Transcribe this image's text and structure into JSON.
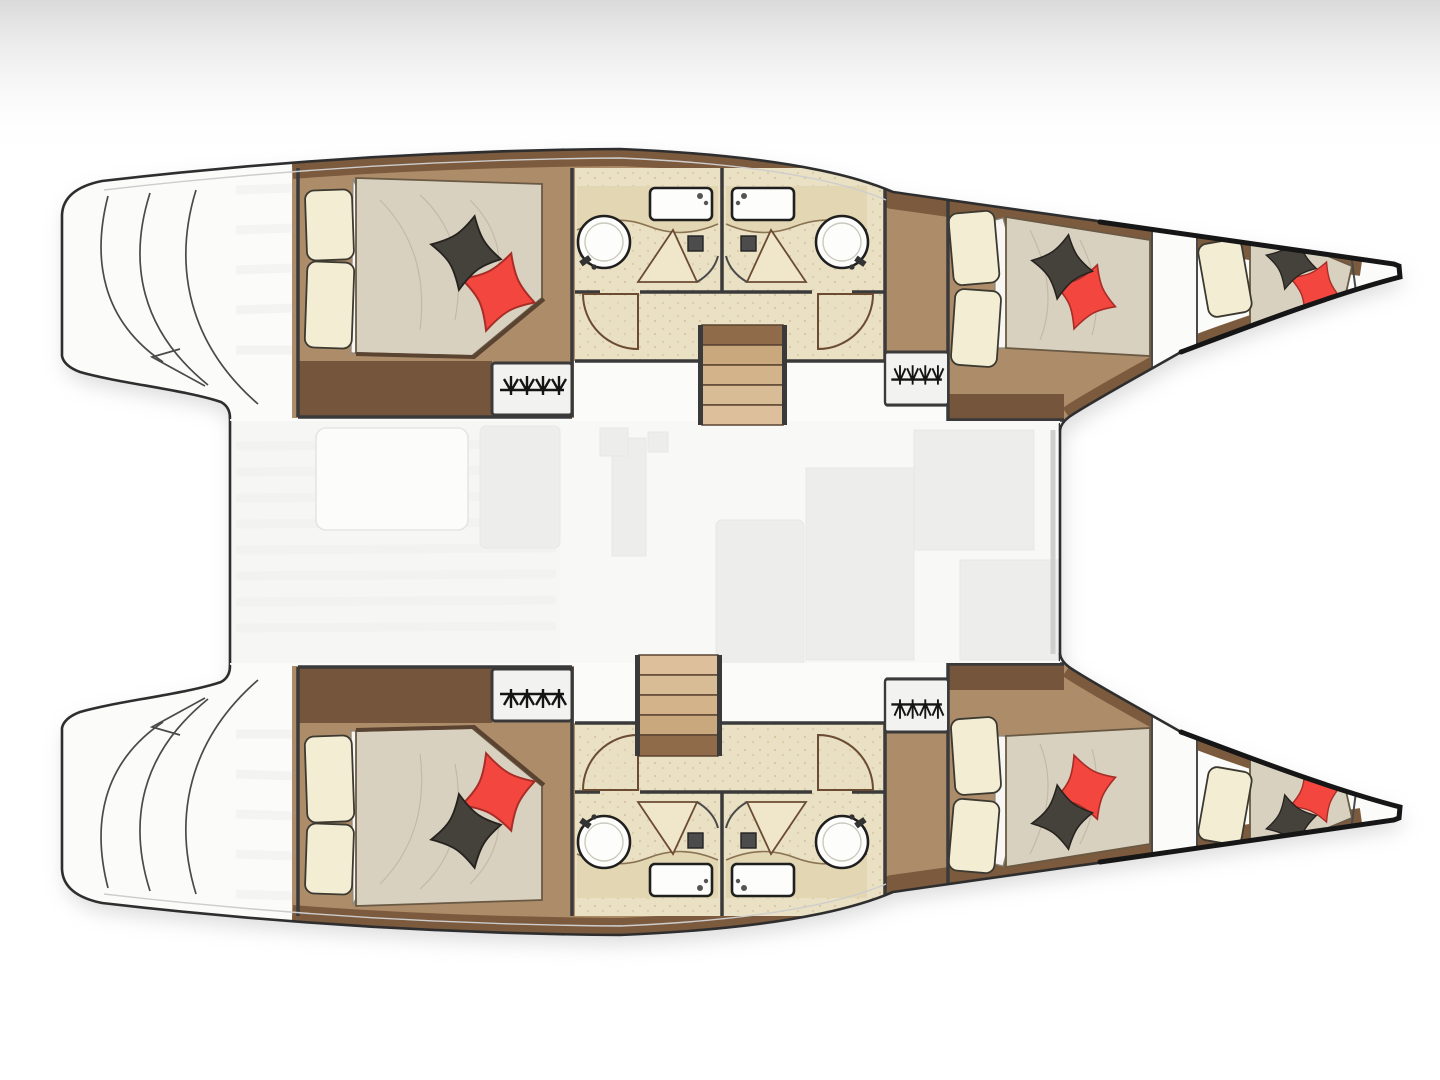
{
  "meta": {
    "alt": "Catamaran yacht top-view floor plan"
  },
  "palette": {
    "bg": "#ffffff",
    "shadow": "#bdbdbd",
    "outline": "#2e2e2e",
    "outlineHeavy": "#161616",
    "hullFill": "#fbfbfa",
    "woodCorridor": "#ad8c6a",
    "woodDark": "#75563c",
    "woodBand": "#7c5a3d",
    "bathFloor": "#eae0c3",
    "bathSpeckle": "#d8c6a0",
    "counter": "#e3d6b2",
    "fixtureWhite": "#fdfdfc",
    "mattress": "#d9d1c0",
    "mattressLine": "#bdb3a0",
    "pillowCream": "#f3edd4",
    "pillowDark": "#45413b",
    "pillowRed": "#f2463e",
    "pillowRedDark": "#a82d27",
    "bridge": "#f6f6f5",
    "ghost": "#ededec"
  },
  "diagram": {
    "type": "boat-floor-plan",
    "vessel": "catamaran",
    "hulls": [
      {
        "name": "port-hull",
        "rooms": [
          "stern-platform",
          "aft-double-cabin",
          "bathroom",
          "bathroom",
          "forward-double-cabin",
          "forepeak-berth"
        ]
      },
      {
        "name": "starboard-hull",
        "rooms": [
          "stern-platform",
          "aft-double-cabin",
          "bathroom",
          "bathroom",
          "forward-double-cabin",
          "forepeak-berth"
        ]
      }
    ],
    "bridgedeck": {
      "rooms": [
        "cockpit",
        "saloon-galley"
      ]
    },
    "counts": {
      "double-cabins": 4,
      "forepeak-berths": 2,
      "bathrooms": 4,
      "staircases": 2,
      "wardrobes": 4,
      "beds": 6
    }
  }
}
